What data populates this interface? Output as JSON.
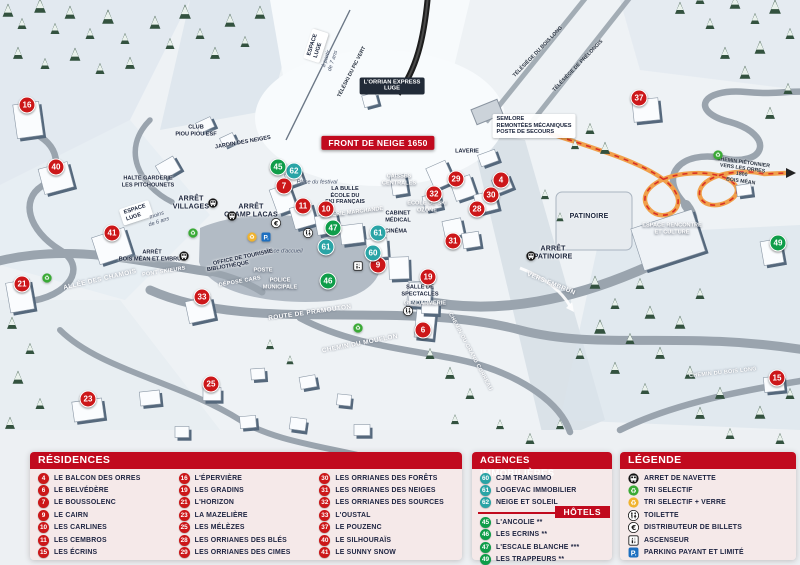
{
  "colors": {
    "accent_red": "#c10a1e",
    "marker_red": "#cc1719",
    "marker_green": "#0f9d49",
    "marker_teal": "#2aa4a6",
    "parking_blue": "#1d6fc0",
    "recycle_green": "#3aaa35",
    "recycle_yellow": "#f0b32e",
    "path_orange": "#f0a04b"
  },
  "map": {
    "markers": [
      {
        "n": "16",
        "type": "residence",
        "x": 27,
        "y": 105
      },
      {
        "n": "40",
        "type": "residence",
        "x": 56,
        "y": 167
      },
      {
        "n": "41",
        "type": "residence",
        "x": 112,
        "y": 233
      },
      {
        "n": "21",
        "type": "residence",
        "x": 22,
        "y": 284
      },
      {
        "n": "33",
        "type": "residence",
        "x": 202,
        "y": 297
      },
      {
        "n": "23",
        "type": "residence",
        "x": 88,
        "y": 399
      },
      {
        "n": "25",
        "type": "residence",
        "x": 211,
        "y": 384
      },
      {
        "n": "7",
        "type": "residence",
        "x": 284,
        "y": 186
      },
      {
        "n": "11",
        "type": "residence",
        "x": 303,
        "y": 206
      },
      {
        "n": "10",
        "type": "residence",
        "x": 326,
        "y": 209
      },
      {
        "n": "9",
        "type": "residence",
        "x": 378,
        "y": 265
      },
      {
        "n": "6",
        "type": "residence",
        "x": 423,
        "y": 330
      },
      {
        "n": "19",
        "type": "residence",
        "x": 428,
        "y": 277
      },
      {
        "n": "31",
        "type": "residence",
        "x": 453,
        "y": 241
      },
      {
        "n": "28",
        "type": "residence",
        "x": 477,
        "y": 209
      },
      {
        "n": "30",
        "type": "residence",
        "x": 491,
        "y": 195
      },
      {
        "n": "32",
        "type": "residence",
        "x": 434,
        "y": 194
      },
      {
        "n": "29",
        "type": "residence",
        "x": 456,
        "y": 179
      },
      {
        "n": "4",
        "type": "residence",
        "x": 501,
        "y": 180
      },
      {
        "n": "37",
        "type": "residence",
        "x": 639,
        "y": 98
      },
      {
        "n": "15",
        "type": "residence",
        "x": 777,
        "y": 378
      },
      {
        "n": "62",
        "type": "agency",
        "x": 294,
        "y": 171
      },
      {
        "n": "61",
        "type": "agency",
        "x": 326,
        "y": 247
      },
      {
        "n": "61",
        "type": "agency",
        "x": 378,
        "y": 233
      },
      {
        "n": "60",
        "type": "agency",
        "x": 373,
        "y": 253
      },
      {
        "n": "45",
        "type": "hotel",
        "x": 278,
        "y": 167
      },
      {
        "n": "47",
        "type": "hotel",
        "x": 333,
        "y": 228
      },
      {
        "n": "46",
        "type": "hotel",
        "x": 328,
        "y": 281
      },
      {
        "n": "49",
        "type": "hotel",
        "x": 778,
        "y": 243
      }
    ],
    "icons": [
      {
        "icon": "bus-icon",
        "x": 213,
        "y": 203
      },
      {
        "icon": "bus-icon",
        "x": 232,
        "y": 216
      },
      {
        "icon": "bus-icon",
        "x": 184,
        "y": 256
      },
      {
        "icon": "bus-icon",
        "x": 531,
        "y": 256
      },
      {
        "icon": "recycle-green-icon",
        "x": 193,
        "y": 233
      },
      {
        "icon": "recycle-green-icon",
        "x": 358,
        "y": 328
      },
      {
        "icon": "recycle-green-icon",
        "x": 718,
        "y": 155
      },
      {
        "icon": "recycle-green-icon",
        "x": 47,
        "y": 278
      },
      {
        "icon": "recycle-yellow-icon",
        "x": 252,
        "y": 237
      },
      {
        "icon": "parking-icon",
        "x": 266,
        "y": 237
      },
      {
        "icon": "toilet-icon",
        "x": 308,
        "y": 233
      },
      {
        "icon": "toilet-icon",
        "x": 408,
        "y": 311
      },
      {
        "icon": "euro-icon",
        "x": 276,
        "y": 223
      },
      {
        "icon": "elevator-icon",
        "x": 358,
        "y": 266
      }
    ],
    "labels": [
      {
        "t": "FRONT DE NEIGE 1650",
        "x": 378,
        "y": 143,
        "s": "chip-red"
      },
      {
        "t": "L'ORRIAN EXPRESS\nLUGE",
        "x": 392,
        "y": 86,
        "s": "chip-dark"
      },
      {
        "t": "ESPACE\nLUGE",
        "x": 316,
        "y": 46,
        "r": -72,
        "s": "chip-white"
      },
      {
        "t": "à partir\nde 7 ans",
        "x": 330,
        "y": 60,
        "r": -72,
        "s": "hint"
      },
      {
        "t": "TÉLÉSKI DU PIC VERT",
        "x": 352,
        "y": 72,
        "r": -63,
        "s": "tiny-dark"
      },
      {
        "t": "TÉLÉSIÈGE DU BOIS LONG",
        "x": 538,
        "y": 52,
        "r": -46,
        "s": "tiny-dark"
      },
      {
        "t": "TÉLÉSIÈGE DE PRÉLONGIS",
        "x": 578,
        "y": 66,
        "r": -46,
        "s": "tiny-dark"
      },
      {
        "t": "SEMLORE\nREMONTÉES MÉCANIQUES\nPOSTE DE SECOURS",
        "x": 534,
        "y": 126,
        "s": "chip-white"
      },
      {
        "t": "CLUB\nPIOU PIOU ESF",
        "x": 196,
        "y": 131,
        "s": "place-sm"
      },
      {
        "t": "JARDIN DES NEIGES",
        "x": 243,
        "y": 143,
        "r": -10,
        "s": "place-sm"
      },
      {
        "t": "HALTE GARDERIE\nLES PITCHOUNETS",
        "x": 148,
        "y": 182,
        "s": "place-sm"
      },
      {
        "t": "ESPACE\nLUGE",
        "x": 136,
        "y": 213,
        "r": -18,
        "s": "chip-white"
      },
      {
        "t": "moins\nde 6 ans",
        "x": 158,
        "y": 219,
        "r": -18,
        "s": "hint"
      },
      {
        "t": "ARRÊT\nVILLAGES",
        "x": 191,
        "y": 204,
        "s": "place"
      },
      {
        "t": "ARRÊT\nCHAMP LACAS",
        "x": 251,
        "y": 212,
        "s": "place"
      },
      {
        "t": "GALERIE MARCHANDE",
        "x": 352,
        "y": 213,
        "r": -7,
        "s": "white-sm"
      },
      {
        "t": "LA BULLE\nÉCOLE DU\nSKI FRANÇAIS",
        "x": 345,
        "y": 196,
        "s": "place-sm"
      },
      {
        "t": "Place du festival",
        "x": 317,
        "y": 183,
        "s": "hint"
      },
      {
        "t": "Place d'accueil",
        "x": 284,
        "y": 252,
        "s": "hint"
      },
      {
        "t": "OFFICE DE TOURISME",
        "x": 243,
        "y": 258,
        "r": -12,
        "s": "place-sm"
      },
      {
        "t": "BIBLIOTHÈQUE",
        "x": 228,
        "y": 267,
        "r": -10,
        "s": "place-sm"
      },
      {
        "t": "POSTE",
        "x": 263,
        "y": 271,
        "s": "white-sm"
      },
      {
        "t": "DÉPOSE CARS",
        "x": 240,
        "y": 282,
        "r": -10,
        "s": "road-sm"
      },
      {
        "t": "POLICE\nMUNICIPALE",
        "x": 280,
        "y": 284,
        "s": "white-sm"
      },
      {
        "t": "CAISSES\nCENTRALES",
        "x": 399,
        "y": 180,
        "s": "white-sm"
      },
      {
        "t": "LAVERIE",
        "x": 467,
        "y": 152,
        "s": "place-sm"
      },
      {
        "t": "ÉCOLE DE SKI\nOZONE",
        "x": 427,
        "y": 207,
        "s": "white-sm"
      },
      {
        "t": "CABINET\nMÉDICAL",
        "x": 398,
        "y": 217,
        "s": "place-sm"
      },
      {
        "t": "CINÉMA",
        "x": 396,
        "y": 232,
        "s": "place-sm"
      },
      {
        "t": "SALLE DE\nSPECTACLES",
        "x": 420,
        "y": 291,
        "s": "place-sm"
      },
      {
        "t": "GENDARMERIE",
        "x": 425,
        "y": 304,
        "s": "white-sm"
      },
      {
        "t": "PATINOIRE",
        "x": 589,
        "y": 217,
        "s": "place"
      },
      {
        "t": "ARRÊT\nPATINOIRE",
        "x": 553,
        "y": 254,
        "s": "place"
      },
      {
        "t": "VERS EMBRUN",
        "x": 551,
        "y": 284,
        "r": 22,
        "s": "road"
      },
      {
        "t": "ESPACE RENCONTRE\nET CULTURE",
        "x": 672,
        "y": 229,
        "s": "white-sm"
      },
      {
        "t": "CHEMIN PIÉTONNIER\nVERS LES ORRES 1800\nBOIS MÉAN",
        "x": 742,
        "y": 172,
        "r": 8,
        "s": "tiny-dark"
      },
      {
        "t": "ALLÉE DES CHAMOIS",
        "x": 100,
        "y": 280,
        "r": -13,
        "s": "road"
      },
      {
        "t": "PONT SKIEURS",
        "x": 164,
        "y": 272,
        "r": -9,
        "s": "road-sm"
      },
      {
        "t": "ARRÊT\nBOIS MÉAN ET EMBRUN",
        "x": 152,
        "y": 256,
        "s": "place-sm"
      },
      {
        "t": "ROUTE DE PRAMOUTON",
        "x": 310,
        "y": 313,
        "r": -8,
        "s": "road"
      },
      {
        "t": "CHEMIN DU MOUFLON",
        "x": 360,
        "y": 344,
        "r": -11,
        "s": "road"
      },
      {
        "t": "CHEMIN DU GRAND CORREAU",
        "x": 470,
        "y": 352,
        "r": 62,
        "s": "road-sm"
      },
      {
        "t": "CHEMIN DU BOIS LONG",
        "x": 723,
        "y": 373,
        "r": -6,
        "s": "road-sm"
      }
    ]
  },
  "panels": {
    "residences": {
      "title": "RÉSIDENCES",
      "columns": [
        [
          {
            "n": "4",
            "label": "LE BALCON DES ORRES"
          },
          {
            "n": "6",
            "label": "LE BELVÉDÈRE"
          },
          {
            "n": "7",
            "label": "LE BOUSSOLENC"
          },
          {
            "n": "9",
            "label": "LE CAIRN"
          },
          {
            "n": "10",
            "label": "LES CARLINES"
          },
          {
            "n": "11",
            "label": "LES CEMBROS"
          },
          {
            "n": "15",
            "label": "LES ÉCRINS"
          }
        ],
        [
          {
            "n": "16",
            "label": "L'ÉPERVIÈRE"
          },
          {
            "n": "19",
            "label": "LES GRADINS"
          },
          {
            "n": "21",
            "label": "L'HORIZON"
          },
          {
            "n": "23",
            "label": "LA MAZELIÈRE"
          },
          {
            "n": "25",
            "label": "LES MÉLÈZES"
          },
          {
            "n": "28",
            "label": "LES ORRIANES DES BLÉS"
          },
          {
            "n": "29",
            "label": "LES ORRIANES DES CIMES"
          }
        ],
        [
          {
            "n": "30",
            "label": "LES ORRIANES DES FORÊTS"
          },
          {
            "n": "31",
            "label": "LES ORRIANES DES NEIGES"
          },
          {
            "n": "32",
            "label": "LES ORRIANES DES SOURCES"
          },
          {
            "n": "33",
            "label": "L'OUSTAL"
          },
          {
            "n": "37",
            "label": "LE POUZENC"
          },
          {
            "n": "40",
            "label": "LE SILHOURAÏS"
          },
          {
            "n": "41",
            "label": "LE SUNNY SNOW"
          }
        ]
      ]
    },
    "agences": {
      "title": "AGENCES IMMOBILIÈRES",
      "items": [
        {
          "n": "60",
          "label": "CJM TRANSIMO"
        },
        {
          "n": "61",
          "label": "LOGEVAC IMMOBILIER"
        },
        {
          "n": "62",
          "label": "NEIGE ET SOLEIL"
        }
      ],
      "hotels_title": "HÔTELS",
      "hotels": [
        {
          "n": "45",
          "label": "L'ANCOLIE **"
        },
        {
          "n": "46",
          "label": "LES ECRINS **"
        },
        {
          "n": "47",
          "label": "L'ESCALE BLANCHE ***"
        },
        {
          "n": "49",
          "label": "LES TRAPPEURS **"
        }
      ]
    },
    "legende": {
      "title": "LÉGENDE",
      "items": [
        {
          "icon": "bus-icon",
          "label": "ARRET DE NAVETTE"
        },
        {
          "icon": "recycle-green-icon",
          "label": "TRI SELECTIF"
        },
        {
          "icon": "recycle-yellow-icon",
          "label": "TRI SELECTIF + VERRE"
        },
        {
          "icon": "toilet-icon",
          "label": "TOILETTE"
        },
        {
          "icon": "euro-icon",
          "label": "DISTRIBUTEUR DE BILLETS"
        },
        {
          "icon": "elevator-icon",
          "label": "ASCENSEUR"
        },
        {
          "icon": "parking-icon",
          "label": "PARKING PAYANT ET LIMITÉ"
        }
      ]
    }
  }
}
